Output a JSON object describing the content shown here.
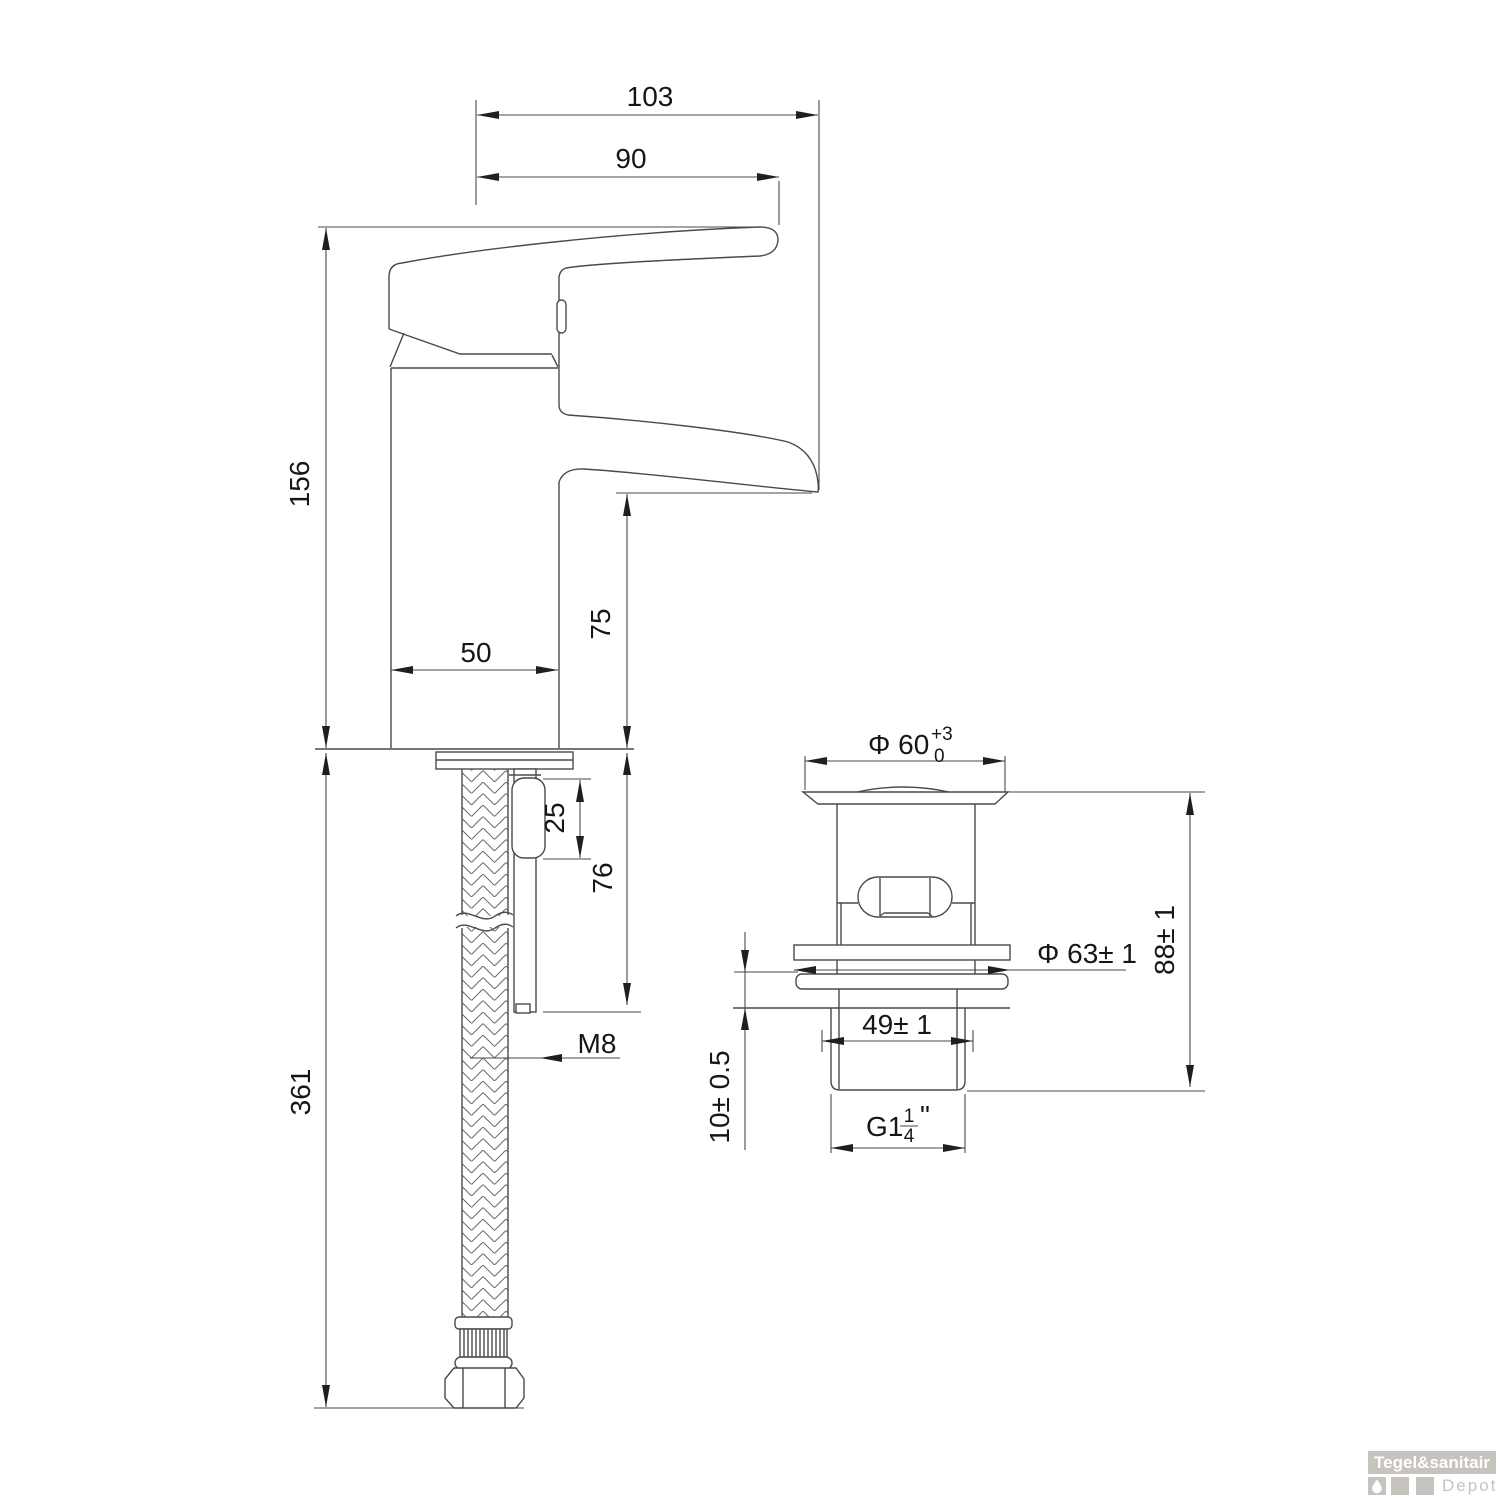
{
  "page": {
    "background": "#ffffff"
  },
  "colors": {
    "line": "#4a4a4a",
    "text": "#161616",
    "logo_gray": "#c7c3bf",
    "logo_banner_text": "#ffffff"
  },
  "faucet": {
    "dims": {
      "overall_reach": "103",
      "handle_reach": "90",
      "body_height": "156",
      "spout_height": "75",
      "body_width": "50",
      "rod_upper_segment": "25",
      "rod_length": "76",
      "rod_thread": "M8",
      "hose_length": "361"
    }
  },
  "drain": {
    "dims": {
      "top_diameter": "Φ 60",
      "top_tol_plus": "+3",
      "top_tol_minus": "0",
      "flange_diameter": "Φ 63± 1",
      "total_height": "88± 1",
      "thread_length": "49± 1",
      "flange_offset": "10± 0.5",
      "thread_g": "G1",
      "thread_frac_num": "1",
      "thread_frac_den": "4",
      "thread_unit": "\""
    }
  },
  "logo": {
    "brand": "Tegel&sanitair",
    "sub": "Depot"
  }
}
